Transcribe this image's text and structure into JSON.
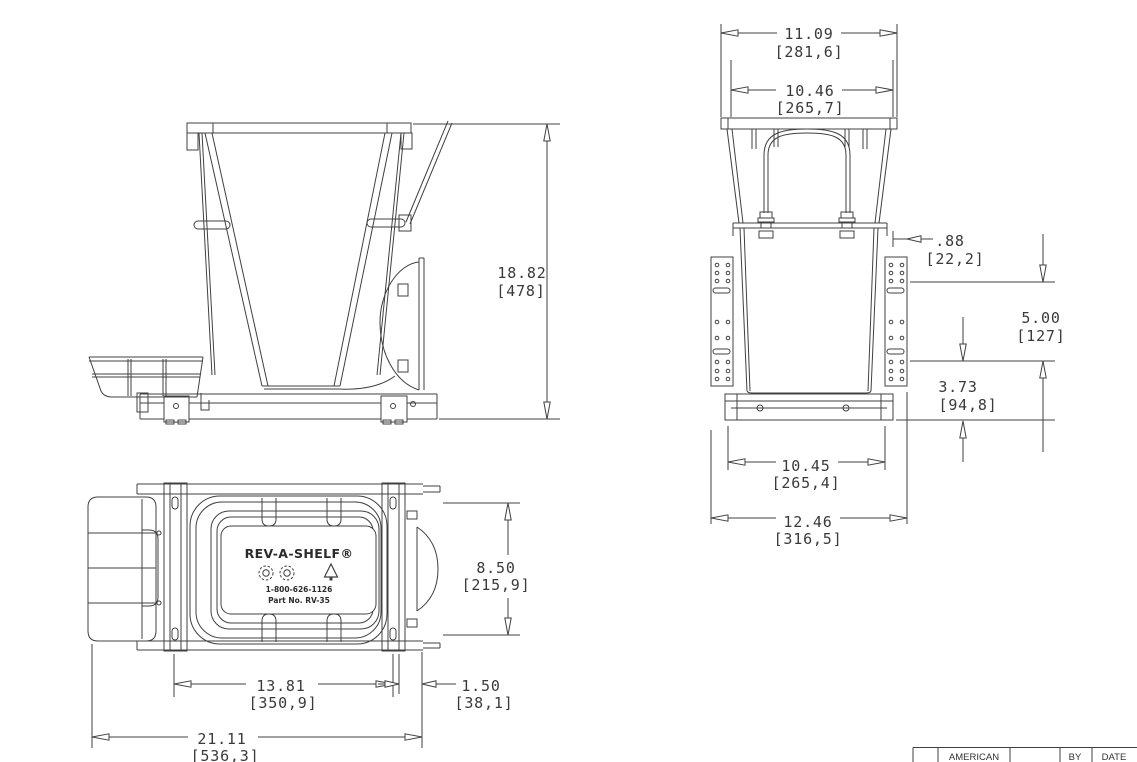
{
  "views": {
    "side": {
      "height": {
        "in": "18.82",
        "mm": "[478]"
      }
    },
    "front": {
      "top_width": {
        "in": "11.09",
        "mm": "[281,6]"
      },
      "inner_width": {
        "in": "10.46",
        "mm": "[265,7]"
      },
      "bracket_offset": {
        "in": ".88",
        "mm": "[22,2]"
      },
      "upper_height": {
        "in": "5.00",
        "mm": "[127]"
      },
      "lower_height": {
        "in": "3.73",
        "mm": "[94,8]"
      },
      "bottom_width": {
        "in": "10.45",
        "mm": "[265,4]"
      },
      "overall_width": {
        "in": "12.46",
        "mm": "[316,5]"
      }
    },
    "plan": {
      "depth": {
        "in": "8.50",
        "mm": "[215,9]"
      },
      "slide_length": {
        "in": "13.81",
        "mm": "[350,9]"
      },
      "door_offset": {
        "in": "1.50",
        "mm": "[38,1]"
      },
      "overall_depth": {
        "in": "21.11",
        "mm": "[536,3]"
      },
      "label": {
        "brand": "REV-A-SHELF®",
        "phone": "1-800-626-1126",
        "part_no": "Part No. RV-35",
        "icons": [
          "recycle-icon",
          "recycle-icon",
          "tree-icon"
        ]
      }
    }
  },
  "title_block": {
    "company": "AMERICAN",
    "by_label": "BY",
    "date_label": "DATE"
  }
}
